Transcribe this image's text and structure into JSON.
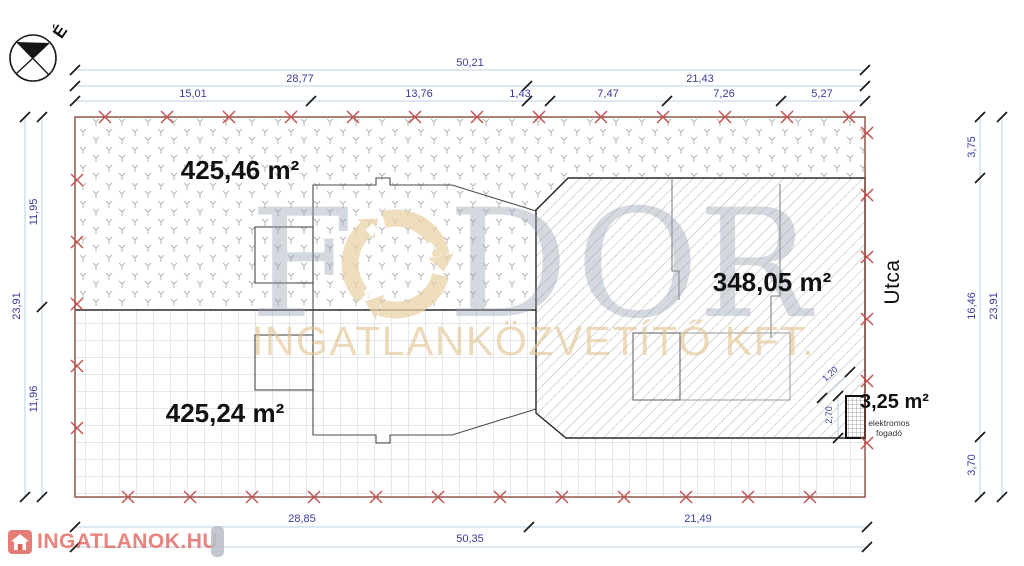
{
  "compass": {
    "north_label": "É"
  },
  "areas": {
    "lawn": "425,46 m²",
    "yard": "425,24 m²",
    "building": "348,05 m²",
    "annex": "3,25 m²"
  },
  "labels": {
    "street": "Utca",
    "annex_caption_line1": "elektromos",
    "annex_caption_line2": "fogadó"
  },
  "dimensions": {
    "top_total": "50,21",
    "top_row2": [
      "28,77",
      "21,43"
    ],
    "top_row3": [
      "15,01",
      "13,76",
      "1,43",
      "7,47",
      "7,26",
      "5,27"
    ],
    "bottom_row1": [
      "28,85",
      "21,49"
    ],
    "bottom_total": "50,35",
    "left_total": "23,91",
    "left_segments": [
      "11,95",
      "11,96"
    ],
    "right_segments": [
      "3,75",
      "16,46",
      "3,70"
    ],
    "right_total": "23,91",
    "annex_width": "1,20",
    "annex_depth": "2,70"
  },
  "watermark": {
    "letters": [
      "F",
      "D",
      "O",
      "R"
    ],
    "subtitle": "INGATLANKÖZVETÍTŐ KFT.",
    "portal": "INGATLANOK.HU"
  },
  "colors": {
    "dimension_text": "#3b3b9e",
    "dimension_line": "#b9d0e2",
    "boundary": "#8a4a3e",
    "cross_marks": "#c65353",
    "portal_red": "#dd6058",
    "watermark_gray": "#9aa4b2",
    "watermark_beige": "#e0c492"
  }
}
